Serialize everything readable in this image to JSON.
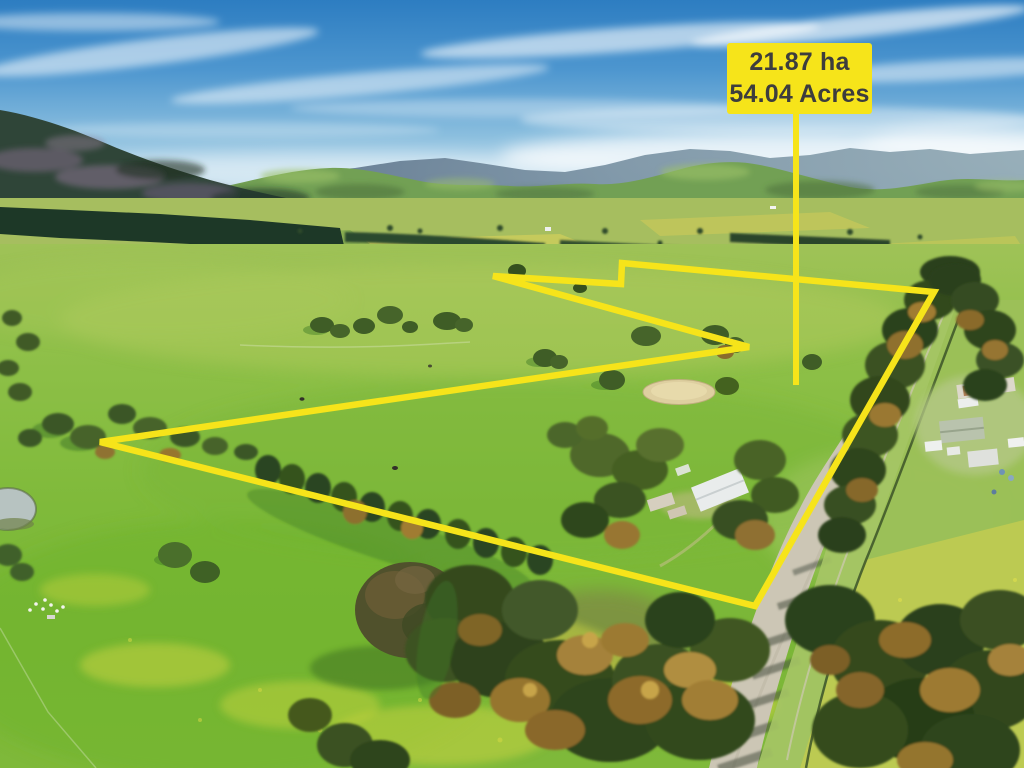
{
  "overlay": {
    "area_label": {
      "line1": "21.87 ha",
      "line2": "54.04 Acres"
    },
    "accent_color": "#F6E41A",
    "label_text_color": "#3D3D3D",
    "boundary_points": "100,442 749,347 493,276 621,284 622,263 934,292 755,606",
    "leader_path": "M796,114 L796,385"
  },
  "scene": {
    "palette": {
      "sky_top": "#2D7DC1",
      "sky_horizon": "#E2EEF2",
      "ridge_haze_blue": "#7D95A6",
      "hill_green": "#72A054",
      "pasture_green": "#7FBA3A",
      "canola_yellow": "#CED63F",
      "forest_dark": "#2C421A",
      "wattle_gold": "#9C7A33",
      "road_gravel": "#CCC6B5",
      "sand_arena": "#DECFA0"
    }
  }
}
